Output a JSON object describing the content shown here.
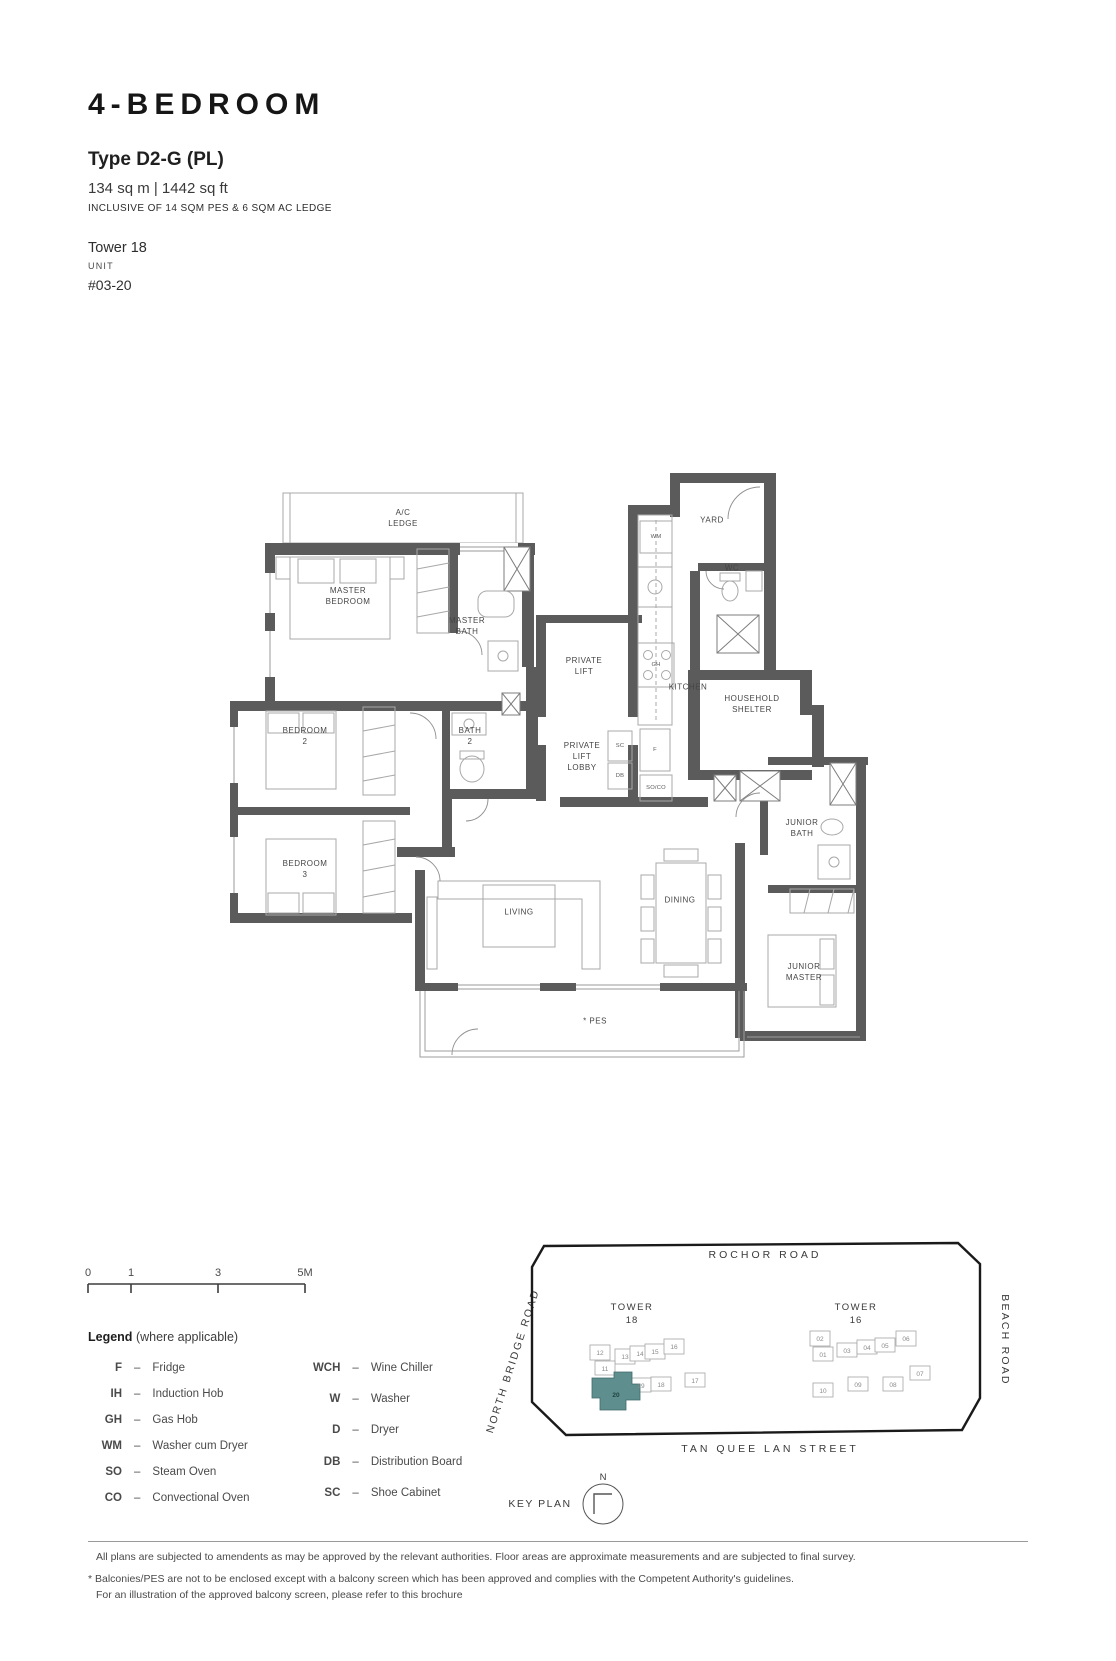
{
  "header": {
    "unit_type": "4-BEDROOM",
    "type_code": "Type D2-G (PL)",
    "area": "134 sq m | 1442 sq ft",
    "area_note": "INCLUSIVE OF 14 SQM PES & 6 SQM AC LEDGE",
    "tower": "Tower 18",
    "unit_label": "UNIT",
    "unit_number": "#03-20"
  },
  "floor_plan": {
    "rooms": [
      {
        "label": "A/C\nLEDGE"
      },
      {
        "label": "MASTER\nBEDROOM"
      },
      {
        "label": "MASTER\nBATH"
      },
      {
        "label": "BEDROOM\n2"
      },
      {
        "label": "BATH\n2"
      },
      {
        "label": "BEDROOM\n3"
      },
      {
        "label": "PRIVATE\nLIFT"
      },
      {
        "label": "PRIVATE\nLIFT\nLOBBY"
      },
      {
        "label": "KITCHEN"
      },
      {
        "label": "YARD"
      },
      {
        "label": "WC"
      },
      {
        "label": "HOUSEHOLD\nSHELTER"
      },
      {
        "label": "JUNIOR\nBATH"
      },
      {
        "label": "JUNIOR\nMASTER"
      },
      {
        "label": "LIVING"
      },
      {
        "label": "DINING"
      },
      {
        "label": "* PES"
      }
    ],
    "appliances": [
      {
        "label": "WM"
      },
      {
        "label": "GH"
      },
      {
        "label": "SC"
      },
      {
        "label": "F"
      },
      {
        "label": "DB"
      },
      {
        "label": "SO/CO"
      }
    ]
  },
  "scale_bar": {
    "ticks": [
      "0",
      "1",
      "3",
      "5M"
    ]
  },
  "legend": {
    "title": "Legend",
    "subtitle": "(where applicable)",
    "dash": "–",
    "col1": [
      {
        "abbr": "F",
        "desc": "Fridge"
      },
      {
        "abbr": "IH",
        "desc": "Induction Hob"
      },
      {
        "abbr": "GH",
        "desc": "Gas Hob"
      },
      {
        "abbr": "WM",
        "desc": "Washer cum Dryer"
      },
      {
        "abbr": "SO",
        "desc": "Steam Oven"
      },
      {
        "abbr": "CO",
        "desc": "Convectional Oven"
      }
    ],
    "col2": [
      {
        "abbr": "WCH",
        "desc": "Wine Chiller"
      },
      {
        "abbr": "W",
        "desc": "Washer"
      },
      {
        "abbr": "D",
        "desc": "Dryer"
      },
      {
        "abbr": "DB",
        "desc": "Distribution Board"
      },
      {
        "abbr": "SC",
        "desc": "Shoe Cabinet"
      }
    ]
  },
  "key_plan": {
    "label": "KEY PLAN",
    "north": "N",
    "highlight_color": "#5e8e8e",
    "roads": {
      "top": "ROCHOR ROAD",
      "left": "NORTH BRIDGE ROAD",
      "right": "BEACH ROAD",
      "bottom": "TAN QUEE LAN STREET"
    },
    "towers": [
      {
        "name": "TOWER",
        "number": "18"
      },
      {
        "name": "TOWER",
        "number": "16"
      }
    ],
    "tower18_units": [
      "12",
      "13",
      "14",
      "15",
      "16",
      "11",
      "19",
      "18",
      "17",
      "20"
    ],
    "tower16_units": [
      "02",
      "01",
      "03",
      "04",
      "05",
      "06",
      "10",
      "09",
      "08",
      "07"
    ]
  },
  "footer": {
    "line1": "All plans are subjected to amendents as may be approved by the relevant authorities. Floor areas are approximate measurements and are subjected to final survey.",
    "line2": "* Balconies/PES are not to be enclosed except with a balcony screen which has been approved and complies with the Competent Authority's guidelines.",
    "line3": "For an illustration of the approved balcony screen, please refer to this brochure"
  }
}
